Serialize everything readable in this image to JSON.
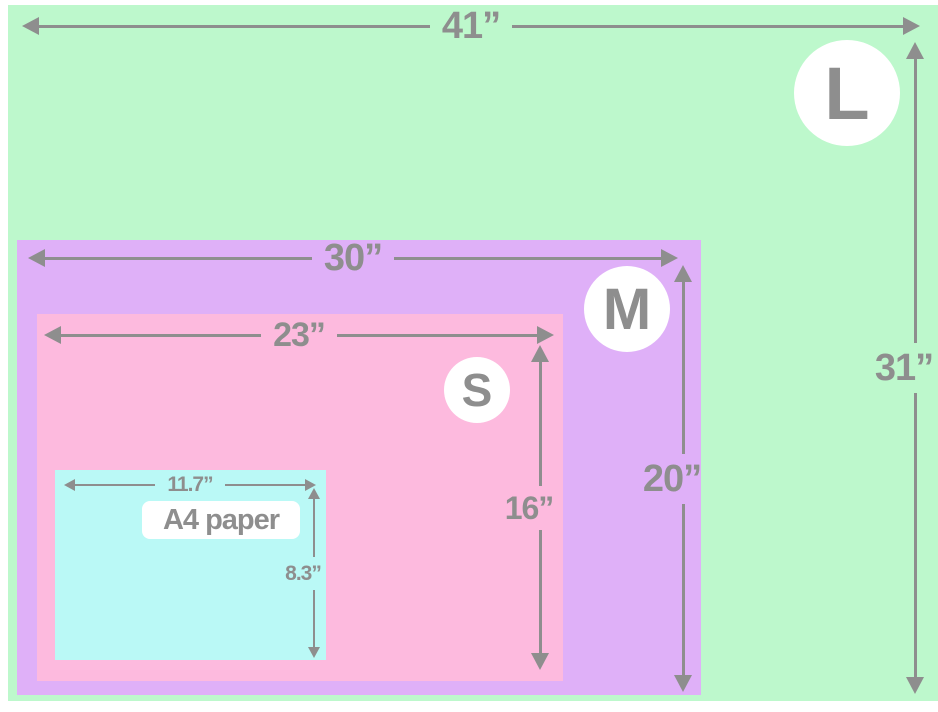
{
  "sizes": [
    {
      "id": "L",
      "label": "L",
      "width_label": "41”",
      "height_label": "31”"
    },
    {
      "id": "M",
      "label": "M",
      "width_label": "30”",
      "height_label": "20”"
    },
    {
      "id": "S",
      "label": "S",
      "width_label": "23”",
      "height_label": "16”"
    },
    {
      "id": "A4",
      "label": "A4 paper",
      "width_label": "11.7”",
      "height_label": "8.3”"
    }
  ],
  "colors": {
    "green": "#bdf8cc",
    "purple": "#dfb0f8",
    "pink": "#fdbade",
    "cyan": "#baf9f6",
    "gray": "#8e8e8e",
    "badge_bg": "#ffffff",
    "page_bg": "#ffffff"
  }
}
